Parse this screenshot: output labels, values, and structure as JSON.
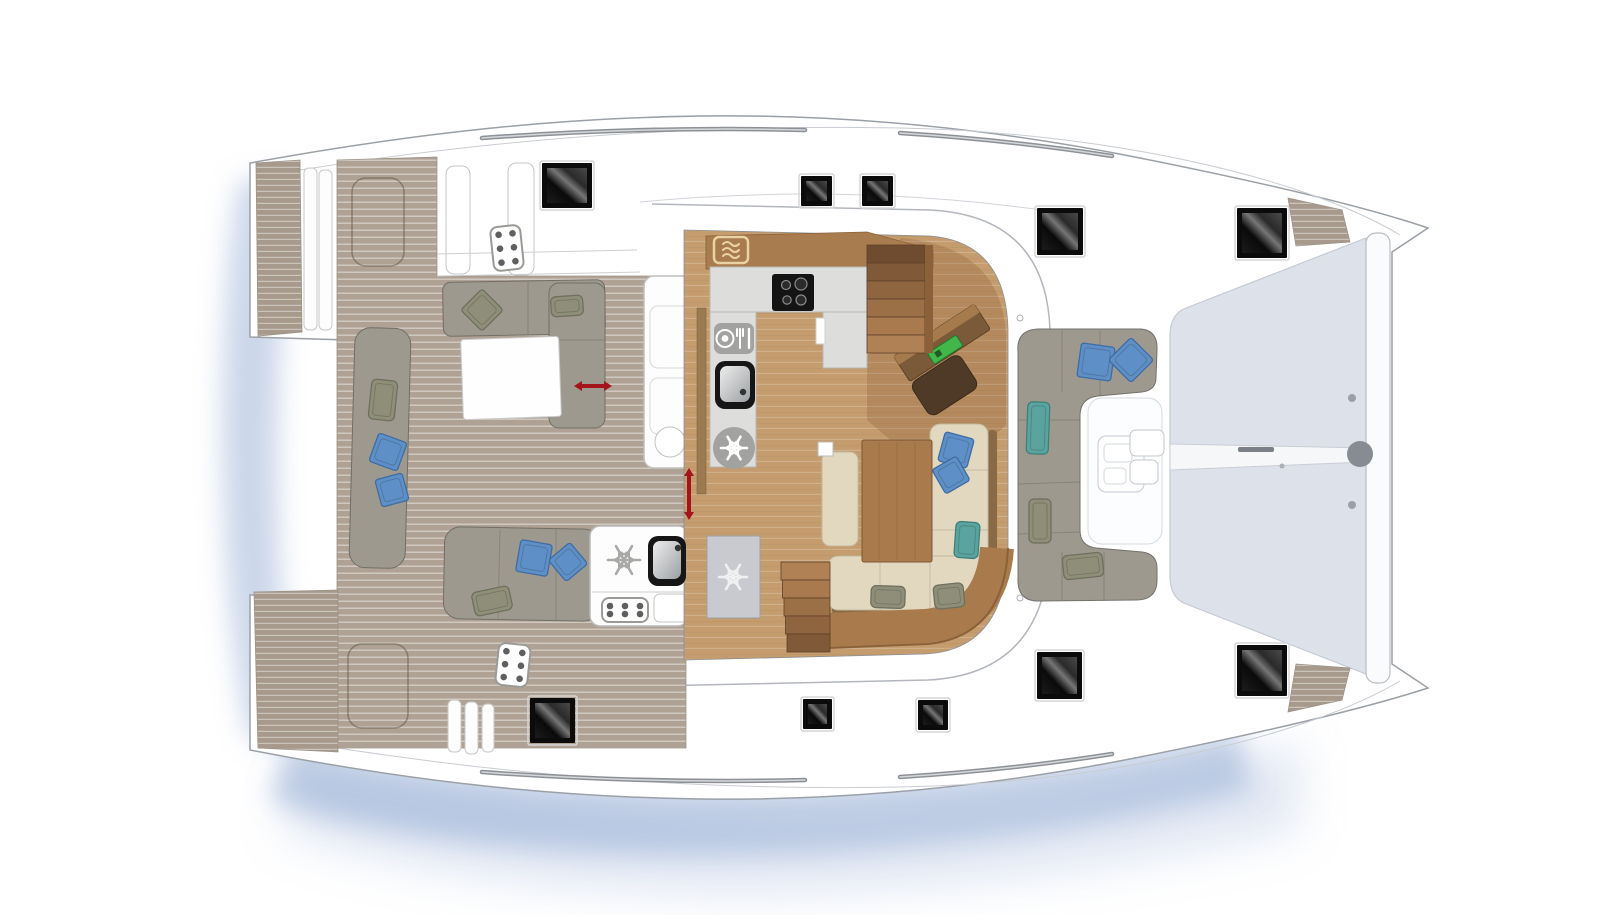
{
  "plan": {
    "kind": "catamaran-deck-floor-plan",
    "orientation": "bow-right",
    "areas": [
      "aft-cockpit",
      "saloon-galley",
      "forward-cockpit",
      "trampoline",
      "swim-platforms"
    ]
  },
  "colors": {
    "hull_fill": "#ffffff",
    "hull_line": "#9aa0a6",
    "soft_line": "#c0c4ca",
    "teak_base": "#afa294",
    "teak_line": "rgba(255,255,255,0.5)",
    "transom_teak": "#a79a8c",
    "wood_floor": "#c49c6e",
    "wood_trim": "#a87c4e",
    "wood_trim_dark": "#8a6138",
    "counter": "#dddddb",
    "counter_edge": "#b9b9b5",
    "sofa_gray": "#9d998f",
    "sofa_gray_edge": "#716e66",
    "sofa_cream": "#e2d8c0",
    "sofa_cream_edge": "#c3b89c",
    "pillow_blue": "#5e8fc6",
    "pillow_blue_edge": "#3f6da3",
    "pillow_teal": "#5ba39e",
    "pillow_teal_edge": "#3f807c",
    "pillow_olive": "#8e8e79",
    "pillow_olive_edge": "#6f6f5e",
    "trampoline": "#dde1e9",
    "trampoline_edge": "#c5cad4",
    "arrow_red": "#a3151b",
    "icon_gray": "#a2a2a0",
    "radio_green": "#42b649",
    "shadow_blue": "rgba(148,172,212,0.55)"
  },
  "deck_hatches": [
    {
      "x": 542,
      "y": 163,
      "w": 50,
      "h": 45
    },
    {
      "x": 801,
      "y": 176,
      "w": 31,
      "h": 30
    },
    {
      "x": 862,
      "y": 176,
      "w": 31,
      "h": 30
    },
    {
      "x": 1037,
      "y": 208,
      "w": 46,
      "h": 47
    },
    {
      "x": 1237,
      "y": 208,
      "w": 50,
      "h": 50
    },
    {
      "x": 530,
      "y": 698,
      "w": 45,
      "h": 45
    },
    {
      "x": 803,
      "y": 699,
      "w": 29,
      "h": 30
    },
    {
      "x": 918,
      "y": 700,
      "w": 30,
      "h": 30
    },
    {
      "x": 1037,
      "y": 652,
      "w": 45,
      "h": 47
    },
    {
      "x": 1237,
      "y": 645,
      "w": 50,
      "h": 51
    }
  ],
  "keypads": [
    {
      "x": 492,
      "y": 226,
      "w": 30,
      "h": 44,
      "rot": -6,
      "cols": 2,
      "rows": 3
    },
    {
      "x": 497,
      "y": 644,
      "w": 32,
      "h": 42,
      "rot": 6,
      "cols": 2,
      "rows": 3
    },
    {
      "x": 602,
      "y": 598,
      "w": 46,
      "h": 24,
      "rot": 0,
      "cols": 3,
      "rows": 2
    }
  ],
  "snowflake_icons": [
    {
      "name": "galley-fridge",
      "cx": 734,
      "cy": 448,
      "r": 21,
      "style": "badge",
      "size": 26
    },
    {
      "name": "tall-fridge",
      "cx": 733,
      "cy": 577,
      "r": 0,
      "style": "glyph-light",
      "size": 28
    },
    {
      "name": "wetbar-fridge",
      "cx": 624,
      "cy": 560,
      "r": 0,
      "style": "glyph-gray",
      "size": 32
    }
  ],
  "dishwasher_icon": {
    "x": 714,
    "y": 323,
    "w": 40,
    "h": 31
  },
  "microwave_icon": {
    "cx": 731,
    "cy": 250,
    "w": 34,
    "h": 26
  },
  "cooktop": {
    "x": 772,
    "y": 274,
    "w": 42,
    "h": 37,
    "burners": [
      {
        "cx": 786,
        "cy": 285,
        "r": 4.5
      },
      {
        "cx": 801,
        "cy": 284,
        "r": 6
      },
      {
        "cx": 787,
        "cy": 300,
        "r": 4.2
      },
      {
        "cx": 801,
        "cy": 300,
        "r": 5
      }
    ]
  },
  "sinks": [
    {
      "x": 715,
      "y": 361,
      "w": 40,
      "h": 48,
      "dotx": 743,
      "doty": 392
    },
    {
      "x": 648,
      "y": 536,
      "w": 38,
      "h": 50,
      "dotx": 678,
      "doty": 548
    }
  ],
  "sliding_door_arrows": [
    {
      "x1": 574,
      "y1": 386,
      "x2": 612,
      "y2": 386
    },
    {
      "x1": 689,
      "y1": 468,
      "x2": 689,
      "y2": 520
    }
  ],
  "stairs": [
    {
      "x": 867,
      "y": 245,
      "w": 58,
      "steps": 6,
      "h": 18,
      "shade": "top-dark"
    },
    {
      "x": 781,
      "y": 562,
      "w": 49,
      "steps": 5,
      "h": 18,
      "shade": "top-light"
    }
  ],
  "pillows": [
    {
      "cx": 482,
      "cy": 310,
      "w": 30,
      "h": 30,
      "rot": 45,
      "color": "olive",
      "shape": "diamond"
    },
    {
      "cx": 567,
      "cy": 306,
      "w": 32,
      "h": 20,
      "rot": -4,
      "color": "olive",
      "shape": "rect"
    },
    {
      "cx": 383,
      "cy": 400,
      "w": 26,
      "h": 40,
      "rot": 6,
      "color": "olive",
      "shape": "rect"
    },
    {
      "cx": 388,
      "cy": 452,
      "w": 30,
      "h": 30,
      "rot": 20,
      "color": "blue",
      "shape": "diamond"
    },
    {
      "cx": 392,
      "cy": 490,
      "w": 28,
      "h": 28,
      "rot": -15,
      "color": "blue",
      "shape": "diamond"
    },
    {
      "cx": 534,
      "cy": 558,
      "w": 32,
      "h": 32,
      "rot": 10,
      "color": "blue",
      "shape": "diamond"
    },
    {
      "cx": 568,
      "cy": 562,
      "w": 28,
      "h": 28,
      "rot": 50,
      "color": "blue",
      "shape": "diamond"
    },
    {
      "cx": 492,
      "cy": 601,
      "w": 38,
      "h": 24,
      "rot": -12,
      "color": "olive",
      "shape": "rect"
    },
    {
      "cx": 1096,
      "cy": 362,
      "w": 34,
      "h": 34,
      "rot": 8,
      "color": "blue",
      "shape": "diamond"
    },
    {
      "cx": 1131,
      "cy": 360,
      "w": 32,
      "h": 32,
      "rot": 45,
      "color": "blue",
      "shape": "diamond"
    },
    {
      "cx": 1038,
      "cy": 428,
      "w": 22,
      "h": 52,
      "rot": 2,
      "color": "teal",
      "shape": "rect"
    },
    {
      "cx": 1040,
      "cy": 521,
      "w": 22,
      "h": 44,
      "rot": 0,
      "color": "olive",
      "shape": "rect"
    },
    {
      "cx": 1083,
      "cy": 566,
      "w": 40,
      "h": 24,
      "rot": -6,
      "color": "olive",
      "shape": "rect"
    },
    {
      "cx": 956,
      "cy": 450,
      "w": 30,
      "h": 30,
      "rot": 15,
      "color": "blue",
      "shape": "diamond"
    },
    {
      "cx": 951,
      "cy": 475,
      "w": 28,
      "h": 28,
      "rot": -30,
      "color": "blue",
      "shape": "diamond"
    },
    {
      "cx": 967,
      "cy": 540,
      "w": 24,
      "h": 36,
      "rot": 4,
      "color": "teal",
      "shape": "rect"
    },
    {
      "cx": 888,
      "cy": 597,
      "w": 34,
      "h": 22,
      "rot": 2,
      "color": "olive",
      "shape": "rect"
    },
    {
      "cx": 949,
      "cy": 596,
      "w": 30,
      "h": 24,
      "rot": -6,
      "color": "olive",
      "shape": "rect"
    }
  ],
  "handrails": [
    {
      "d": "M 482,138 Q 650,126 805,130"
    },
    {
      "d": "M 900,133 Q 1010,140 1112,156"
    },
    {
      "d": "M 482,772 Q 650,784 805,780"
    },
    {
      "d": "M 900,777 Q 1010,770 1112,754"
    }
  ],
  "bow_steps": [
    {
      "points": "1288,198 1342,210 1350,242 1296,246"
    },
    {
      "points": "1288,712 1342,700 1350,668 1296,664"
    }
  ]
}
